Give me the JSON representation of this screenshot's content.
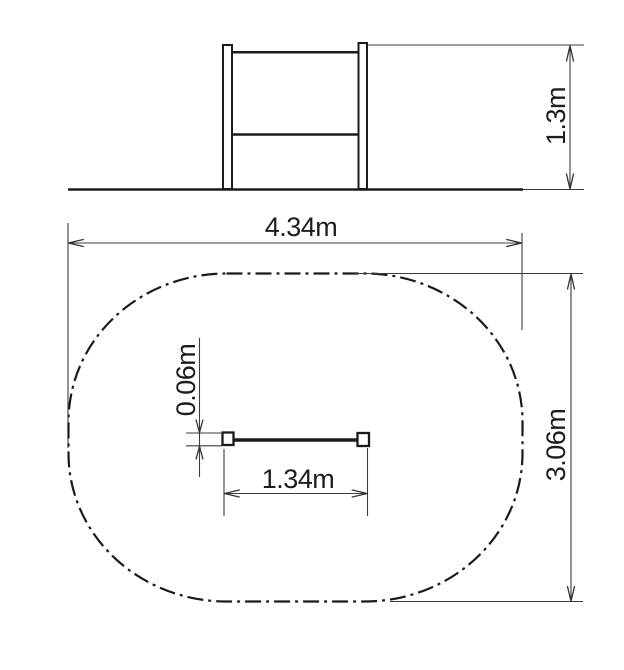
{
  "drawing": {
    "background": "#ffffff",
    "line_color": "#1b1b1b",
    "dimension_color": "#3c3c3c",
    "views": {
      "elevation": {
        "title": "front-elevation-of-rail-structure",
        "height": {
          "label": "1.3m"
        }
      },
      "plan": {
        "title": "plan-view-safety-zone",
        "zone_width": {
          "label": "4.34m"
        },
        "zone_depth": {
          "label": "3.06m"
        },
        "equipment_length": {
          "label": "1.34m"
        },
        "post_size": {
          "label": "0.06m"
        }
      }
    }
  }
}
